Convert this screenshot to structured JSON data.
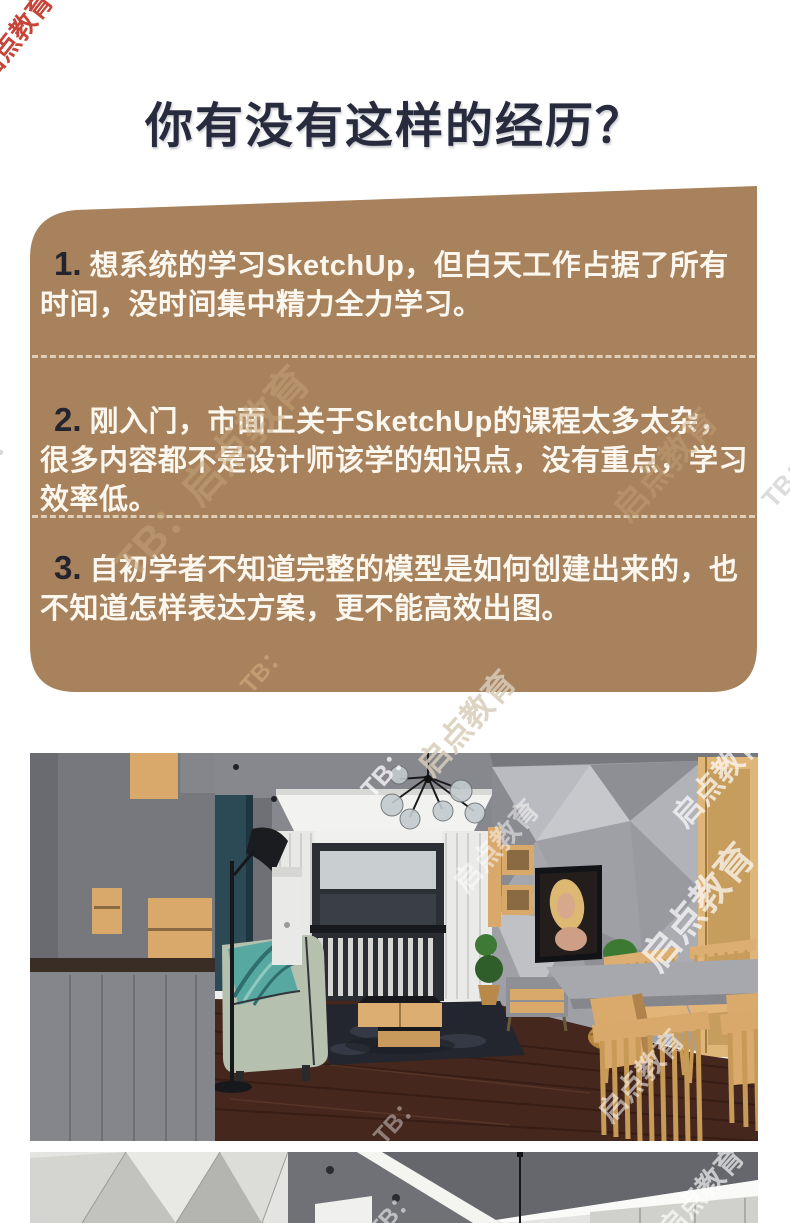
{
  "page": {
    "title": "你有没有这样的经历？",
    "background_color": "#ffffff"
  },
  "pain_card": {
    "bg_color": "#a8825c",
    "text_color": "#fbf7ee",
    "number_color": "#23242f",
    "items": [
      {
        "number": "1.",
        "text": "想系统的学习SketchUp，但白天工作占据了所有时间，没时间集中精力全力学习。"
      },
      {
        "number": "2.",
        "text": "刚入门，市面上关于SketchUp的课程太多太杂，很多内容都不是设计师该学的知识点，没有重点，学习效率低。"
      },
      {
        "number": "3.",
        "text": "自初学者不知道完整的模型是如何创建出来的，也不知道怎样表达方案，更不能高效出图。"
      }
    ]
  },
  "watermark": {
    "full": "TB：启点教育",
    "brand": "启点教育",
    "tag": "TB：",
    "corner_color": "#c43a2e"
  },
  "photos": [
    {
      "name": "living-room-render",
      "alt": "SketchUp 客厅室内效果图"
    },
    {
      "name": "render-strip",
      "alt": "SketchUp 室内效果图（局部）"
    }
  ]
}
